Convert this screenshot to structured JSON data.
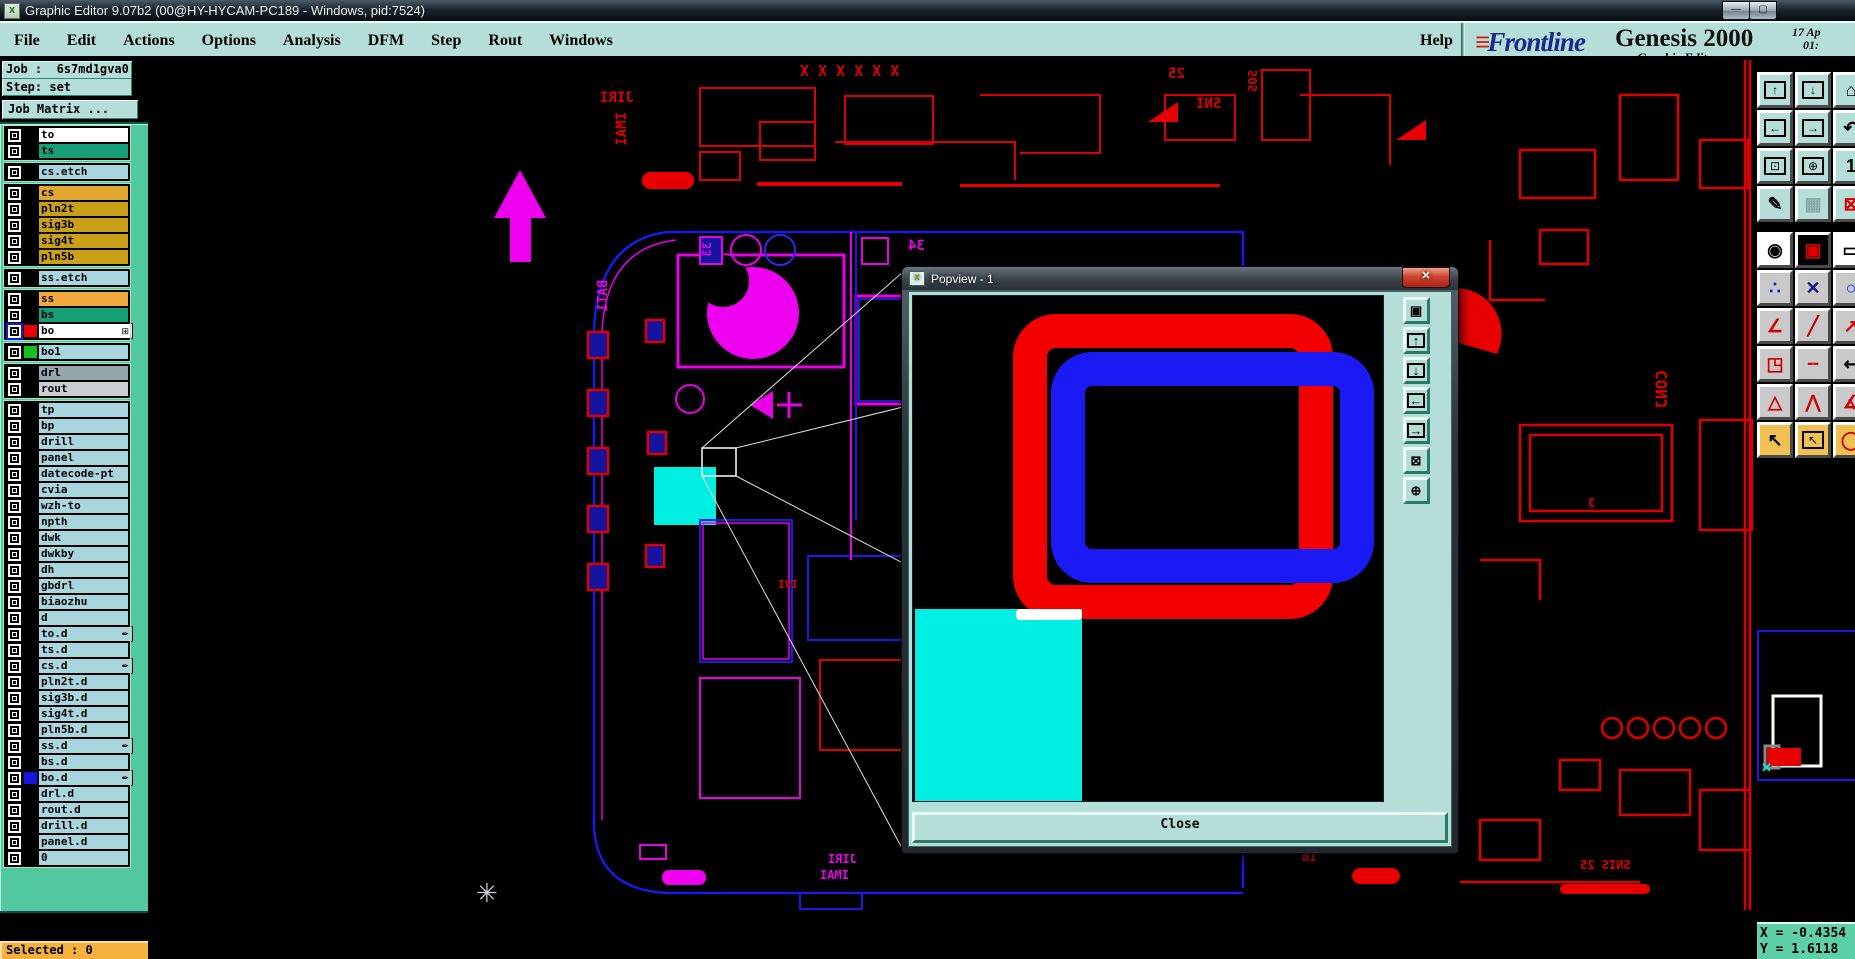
{
  "window": {
    "title": "Graphic Editor 9.07b2 (00@HY-HYCAM-PC189 - Windows, pid:7524)",
    "app_icon": "x",
    "controls": {
      "minimize": "—",
      "maximize": "▢"
    }
  },
  "menu_bar": {
    "items": [
      "File",
      "Edit",
      "Actions",
      "Options",
      "Analysis",
      "DFM",
      "Step",
      "Rout",
      "Windows"
    ],
    "help": "Help"
  },
  "brand": {
    "logo": "Frontline",
    "logo_speed_lines": "≡",
    "product": "Genesis 2000",
    "date": "17 Ap",
    "time": "01:",
    "subtitle": "Graphic Editor"
  },
  "job_panel": {
    "job_label": "Job :",
    "job_value": "6s7md1gva0",
    "step_label": "Step:",
    "step_value": "set",
    "matrix_button": "Job Matrix ..."
  },
  "layers": {
    "groups": [
      [
        {
          "label": "to",
          "bg": "#ffffff"
        },
        {
          "label": "ts",
          "bg": "#17a078"
        }
      ],
      [
        {
          "label": "cs.etch",
          "bg": "#a9d6de"
        }
      ],
      [
        {
          "label": "cs",
          "bg": "#e2a72e"
        },
        {
          "label": "pln2t",
          "bg": "#caa018"
        },
        {
          "label": "sig3b",
          "bg": "#caa018"
        },
        {
          "label": "sig4t",
          "bg": "#caa018"
        },
        {
          "label": "pln5b",
          "bg": "#caa018"
        }
      ],
      [
        {
          "label": "ss.etch",
          "bg": "#a9d6de"
        }
      ],
      [
        {
          "label": "ss",
          "bg": "#f1a83c"
        },
        {
          "label": "bs",
          "bg": "#17a078"
        },
        {
          "label": "bo",
          "bg": "#ffffff",
          "cb": "#1515e0",
          "swatch": "#e80000",
          "icon": "⊞"
        }
      ],
      [
        {
          "label": "bo1",
          "bg": "#a9d6de",
          "swatch": "#14c020"
        }
      ],
      [
        {
          "label": "drl",
          "bg": "#97a6ad"
        },
        {
          "label": "rout",
          "bg": "#c9ced1"
        }
      ],
      [
        {
          "label": "tp",
          "bg": "#a9d6de"
        },
        {
          "label": "bp",
          "bg": "#a9d6de"
        },
        {
          "label": "drill",
          "bg": "#a9d6de"
        },
        {
          "label": "panel",
          "bg": "#a9d6de"
        },
        {
          "label": "datecode-pt",
          "bg": "#a9d6de"
        },
        {
          "label": "cvia",
          "bg": "#a9d6de"
        },
        {
          "label": "wzh-to",
          "bg": "#a9d6de"
        },
        {
          "label": "npth",
          "bg": "#a9d6de"
        },
        {
          "label": "dwk",
          "bg": "#a9d6de"
        },
        {
          "label": "dwkby",
          "bg": "#a9d6de"
        },
        {
          "label": "dh",
          "bg": "#a9d6de"
        },
        {
          "label": "gbdrl",
          "bg": "#a9d6de"
        },
        {
          "label": "biaozhu",
          "bg": "#a9d6de"
        },
        {
          "label": "d",
          "bg": "#a9d6de"
        },
        {
          "label": "to.d",
          "bg": "#a9d6de",
          "icon": "✒"
        },
        {
          "label": "ts.d",
          "bg": "#a9d6de"
        },
        {
          "label": "cs.d",
          "bg": "#a9d6de",
          "icon": "✒"
        },
        {
          "label": "pln2t.d",
          "bg": "#a9d6de"
        },
        {
          "label": "sig3b.d",
          "bg": "#a9d6de"
        },
        {
          "label": "sig4t.d",
          "bg": "#a9d6de"
        },
        {
          "label": "pln5b.d",
          "bg": "#a9d6de"
        },
        {
          "label": "ss.d",
          "bg": "#a9d6de",
          "icon": "✒"
        },
        {
          "label": "bs.d",
          "bg": "#a9d6de"
        },
        {
          "label": "bo.d",
          "bg": "#a9d6de",
          "swatch": "#1515e0",
          "icon": "✒"
        },
        {
          "label": "drl.d",
          "bg": "#a9d6de"
        },
        {
          "label": "rout.d",
          "bg": "#a9d6de"
        },
        {
          "label": "drill.d",
          "bg": "#a9d6de"
        },
        {
          "label": "panel.d",
          "bg": "#a9d6de"
        },
        {
          "label": "0",
          "bg": "#a9d6de"
        }
      ]
    ]
  },
  "status": {
    "selected": "Selected : 0",
    "x_readout": "X = -0.4354",
    "y_readout": "Y = 1.6118"
  },
  "popview": {
    "title": "Popview - 1",
    "close_x": "x",
    "close_button": "Close",
    "tool_icons": [
      {
        "name": "popview-detach-button",
        "glyph": "▣",
        "boxed": false
      },
      {
        "name": "popview-pan-up-button",
        "glyph": "↑",
        "boxed": true
      },
      {
        "name": "popview-pan-down-button",
        "glyph": "↓",
        "boxed": true
      },
      {
        "name": "popview-pan-left-button",
        "glyph": "←",
        "boxed": true
      },
      {
        "name": "popview-pan-right-button",
        "glyph": "→",
        "boxed": true
      },
      {
        "name": "popview-zoom-fit-button",
        "glyph": "⊠",
        "boxed": false
      },
      {
        "name": "popview-pan-center-button",
        "glyph": "⊕",
        "boxed": false
      }
    ]
  },
  "right_toolbar": {
    "buttons": [
      {
        "name": "pan-up-button",
        "glyph": "↑",
        "boxed": true,
        "bg": "#b6ded8",
        "fg": "#000"
      },
      {
        "name": "pan-down-button",
        "glyph": "↓",
        "boxed": true,
        "bg": "#b6ded8",
        "fg": "#000"
      },
      {
        "name": "home-view-button",
        "glyph": "⌂",
        "bg": "#b6ded8",
        "fg": "#000"
      },
      {
        "name": "pan-left-button",
        "glyph": "←",
        "boxed": true,
        "bg": "#b6ded8",
        "fg": "#000"
      },
      {
        "name": "pan-right-button",
        "glyph": "→",
        "boxed": true,
        "bg": "#b6ded8",
        "fg": "#000"
      },
      {
        "name": "undo-view-button",
        "glyph": "↶",
        "bg": "#b6ded8",
        "fg": "#000"
      },
      {
        "name": "zoom-fit-button",
        "glyph": "⊡",
        "boxed": true,
        "bg": "#b6ded8",
        "fg": "#000"
      },
      {
        "name": "pan-around-button",
        "glyph": "⊕",
        "boxed": true,
        "bg": "#b6ded8",
        "fg": "#000"
      },
      {
        "name": "actual-size-button",
        "glyph": "1",
        "bg": "#b6ded8",
        "fg": "#000"
      },
      {
        "name": "color-setup-button",
        "glyph": "✎",
        "bg": "#b6ded8",
        "fg": "#000"
      },
      {
        "name": "grid-button",
        "glyph": "▦",
        "bg": "#b6ded8",
        "fg": "#8aa"
      },
      {
        "name": "netlist-button",
        "glyph": "⊠",
        "bg": "#b6ded8",
        "fg": "#d00000"
      },
      {
        "spacer": true
      },
      {
        "name": "zoom-area-button",
        "glyph": "◉",
        "bg": "#ffffff",
        "fg": "#000"
      },
      {
        "name": "popview-button",
        "glyph": "▣",
        "bg": "#000000",
        "fg": "#e00000"
      },
      {
        "name": "measure-button",
        "glyph": "▭",
        "bg": "#ffffff",
        "fg": "#000"
      },
      {
        "name": "net-points-button",
        "glyph": "∴",
        "bg": "#c9c9c9",
        "fg": "#1515e0"
      },
      {
        "name": "clear-highlight-button",
        "glyph": "✕",
        "bg": "#c9c9c9",
        "fg": "#10108a"
      },
      {
        "name": "circle-select-button",
        "glyph": "○",
        "bg": "#c9c9c9",
        "fg": "#1515e0"
      },
      {
        "name": "angle-measure-button",
        "glyph": "∠",
        "bg": "#c9c9c9",
        "fg": "#d00000"
      },
      {
        "name": "slope-line-button",
        "glyph": "╱",
        "bg": "#c9c9c9",
        "fg": "#d00000"
      },
      {
        "name": "line-arrow-button",
        "glyph": "↗",
        "bg": "#c9c9c9",
        "fg": "#d00000"
      },
      {
        "name": "pad-copy-button",
        "glyph": "◳",
        "bg": "#c9c9c9",
        "fg": "#d00000"
      },
      {
        "name": "dashed-line-button",
        "glyph": "╌",
        "bg": "#c9c9c9",
        "fg": "#d00000"
      },
      {
        "name": "dimension-button",
        "glyph": "↤",
        "bg": "#c9c9c9",
        "fg": "#000"
      },
      {
        "name": "triangle-marker-button",
        "glyph": "△",
        "bg": "#c9c9c9",
        "fg": "#d00000"
      },
      {
        "name": "peak-marker-button",
        "glyph": "⋀",
        "bg": "#c9c9c9",
        "fg": "#d00000"
      },
      {
        "name": "angle2-button",
        "glyph": "∡",
        "bg": "#c9c9c9",
        "fg": "#d00000"
      },
      {
        "name": "select-arrow-button",
        "glyph": "↖",
        "bg": "#f0c053",
        "fg": "#000"
      },
      {
        "name": "select-frame-button",
        "glyph": "↖",
        "boxed": true,
        "bg": "#f0c053",
        "fg": "#000"
      },
      {
        "name": "select-round-button",
        "glyph": "◯",
        "bg": "#f0c053",
        "fg": "#d00000"
      }
    ]
  },
  "canvas": {
    "silkscreen": [
      {
        "text": "JIRI",
        "x": 600,
        "y": 90,
        "color": "#dc0000",
        "size": 14
      },
      {
        "text": "IMAI",
        "x": 614,
        "y": 112,
        "color": "#dc0000",
        "size": 14,
        "vert": true
      },
      {
        "text": "X X X X X X",
        "x": 800,
        "y": 62,
        "color": "#dc0000",
        "size": 15
      },
      {
        "text": "25",
        "x": 1168,
        "y": 66,
        "color": "#dc0000",
        "size": 14
      },
      {
        "text": "SNI",
        "x": 1196,
        "y": 96,
        "color": "#dc0000",
        "size": 14
      },
      {
        "text": "SOS",
        "x": 1246,
        "y": 70,
        "color": "#dc0000",
        "size": 12,
        "vert": true
      },
      {
        "text": "34",
        "x": 908,
        "y": 238,
        "color": "#e800e8",
        "size": 14
      },
      {
        "text": "33",
        "x": 700,
        "y": 242,
        "color": "#e800e8",
        "size": 12,
        "vert": true
      },
      {
        "text": "BAT1",
        "x": 596,
        "y": 280,
        "color": "#e800e8",
        "size": 13,
        "vert": true
      },
      {
        "text": "CONJ",
        "x": 1652,
        "y": 370,
        "color": "#dc0000",
        "size": 16,
        "vert": true
      },
      {
        "text": "IVI",
        "x": 778,
        "y": 578,
        "color": "#dc0000",
        "size": 11
      },
      {
        "text": "3",
        "x": 1588,
        "y": 496,
        "color": "#dc0000",
        "size": 12
      },
      {
        "text": "JIRI",
        "x": 828,
        "y": 852,
        "color": "#e800e8",
        "size": 12
      },
      {
        "text": "IMAI",
        "x": 820,
        "y": 868,
        "color": "#e800e8",
        "size": 12
      },
      {
        "text": "IW",
        "x": 1302,
        "y": 850,
        "color": "#dc0000",
        "size": 12
      },
      {
        "text": "SNIS 25",
        "x": 1580,
        "y": 858,
        "color": "#dc0000",
        "size": 12
      }
    ],
    "compass_glyph": "✳"
  },
  "colors": {
    "ui_teal": "#b6ded8",
    "panel_green": "#52c89e",
    "selected_amber": "#f4b13e",
    "trace_red": "#dc0000",
    "trace_magenta": "#e800e8",
    "board_blue": "#1a1ae8",
    "highlight_cyan": "#00efe2",
    "popview_red": "#f50000",
    "popview_blue": "#1a1af5"
  }
}
